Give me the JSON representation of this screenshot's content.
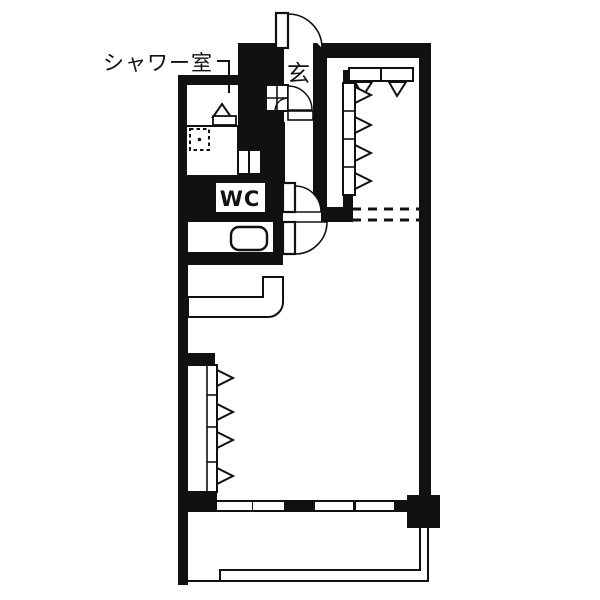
{
  "plan": {
    "labels": {
      "shower_room": "シャワー室",
      "entrance": "玄",
      "toilet": "WC"
    },
    "colors": {
      "wall": "#111111",
      "floor": "#ffffff"
    },
    "features": {
      "entrance_door": "swing-door-arc",
      "wc_door": "swing-door-arc",
      "main_room_door": "swing-door-arc",
      "closets": "folding-door-triangles",
      "washing_machine_space": "dashed-square",
      "balcony": "thin-double-rail",
      "windows": "white-slots-in-wall"
    }
  }
}
